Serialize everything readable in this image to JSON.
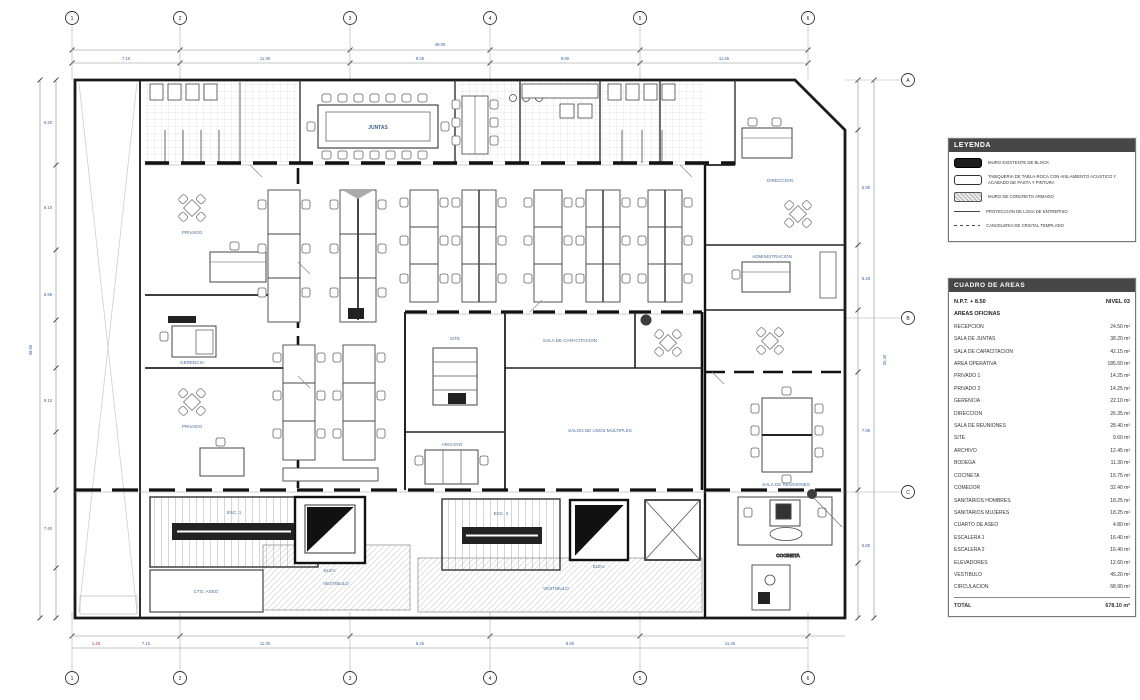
{
  "plan": {
    "grid_cols": [
      "1",
      "2",
      "3",
      "4",
      "5",
      "6"
    ],
    "grid_rows": [
      "A",
      "B",
      "C"
    ],
    "dim_top_overall": "49.00",
    "dims_top": [
      "7.10",
      "11.30",
      "9.25",
      "9.90",
      "11.45"
    ],
    "dims_bottom": [
      "7.10",
      "11.30",
      "9.25",
      "9.90",
      "11.45"
    ],
    "dim_bottom_small": "1.20",
    "dims_left": [
      "6.20",
      "6.10",
      "5.95",
      "8.10",
      "7.40"
    ],
    "dim_left_overall": "38.55",
    "dims_right": [
      "5.90",
      "6.25",
      "7.95",
      "6.80"
    ],
    "dim_right_overall": "35.40",
    "rooms": {
      "juntas": "JUNTAS",
      "privado1": "PRIVADO",
      "gerencia": "GERENCIA",
      "privado2": "PRIVADO",
      "capacitacion": "SALA DE CAPACITACION",
      "usos": "SALON DE USOS MULTIPLES",
      "site": "SITE",
      "archivo": "ARCHIVO",
      "direccion": "DIRECCION",
      "admin": "ADMINISTRACION",
      "reuniones": "SALA DE REUNIONES",
      "cocineta": "COCINETA",
      "escalera1": "ESC. 1",
      "escalera2": "ESC. 2",
      "vestibulo1": "VESTIBULO",
      "vestibulo2": "VESTIBULO",
      "aseo": "CTO. ASEO",
      "elev1": "ELEV.",
      "elev2": "ELEV."
    }
  },
  "legend": {
    "header": "LEYENDA",
    "items": [
      {
        "swatch": "solid",
        "label": "MURO EXISTENTE DE BLOCK"
      },
      {
        "swatch": "outline",
        "label": "TABIQUERIA DE TABLA-ROCA CON AISLAMIENTO ACUSTICO Y ACABADO DE PASTA Y PINTURA"
      },
      {
        "swatch": "concrete",
        "label": "MURO DE CONCRETO ARMADO"
      },
      {
        "swatch": "line-dot",
        "label": "PROYECCION DE LOSA DE ENTREPISO"
      },
      {
        "swatch": "dashed",
        "label": "CANCELERIA DE CRISTAL TEMPLADO"
      }
    ]
  },
  "area_table": {
    "header": "CUADRO DE AREAS",
    "level_label": "N.P.T. + 8.50",
    "level_value": "NIVEL 03",
    "section": "AREAS OFICINAS",
    "rows": [
      {
        "name": "RECEPCION",
        "value": "24.50 m²"
      },
      {
        "name": "SALA DE JUNTAS",
        "value": "38.20 m²"
      },
      {
        "name": "SALA DE CAPACITACION",
        "value": "42.15 m²"
      },
      {
        "name": "AREA OPERATIVA",
        "value": "185.60 m²"
      },
      {
        "name": "PRIVADO 1",
        "value": "14.25 m²"
      },
      {
        "name": "PRIVADO 2",
        "value": "14.25 m²"
      },
      {
        "name": "GERENCIA",
        "value": "22.10 m²"
      },
      {
        "name": "DIRECCION",
        "value": "26.35 m²"
      },
      {
        "name": "SALA DE REUNIONES",
        "value": "28.40 m²"
      },
      {
        "name": "SITE",
        "value": "9.60 m²"
      },
      {
        "name": "ARCHIVO",
        "value": "12.45 m²"
      },
      {
        "name": "BODEGA",
        "value": "11.30 m²"
      },
      {
        "name": "COCINETA",
        "value": "15.75 m²"
      },
      {
        "name": "COMEDOR",
        "value": "32.40 m²"
      },
      {
        "name": "SANITARIOS HOMBRES",
        "value": "18.25 m²"
      },
      {
        "name": "SANITARIOS MUJERES",
        "value": "18.25 m²"
      },
      {
        "name": "CUARTO DE ASEO",
        "value": "4.80 m²"
      },
      {
        "name": "ESCALERA 1",
        "value": "16.40 m²"
      },
      {
        "name": "ESCALERA 2",
        "value": "16.40 m²"
      },
      {
        "name": "ELEVADORES",
        "value": "12.60 m²"
      },
      {
        "name": "VESTIBULO",
        "value": "45.20 m²"
      },
      {
        "name": "CIRCULACION",
        "value": "68.90 m²"
      }
    ],
    "total_label": "TOTAL",
    "total_value": "678.10 m²"
  }
}
